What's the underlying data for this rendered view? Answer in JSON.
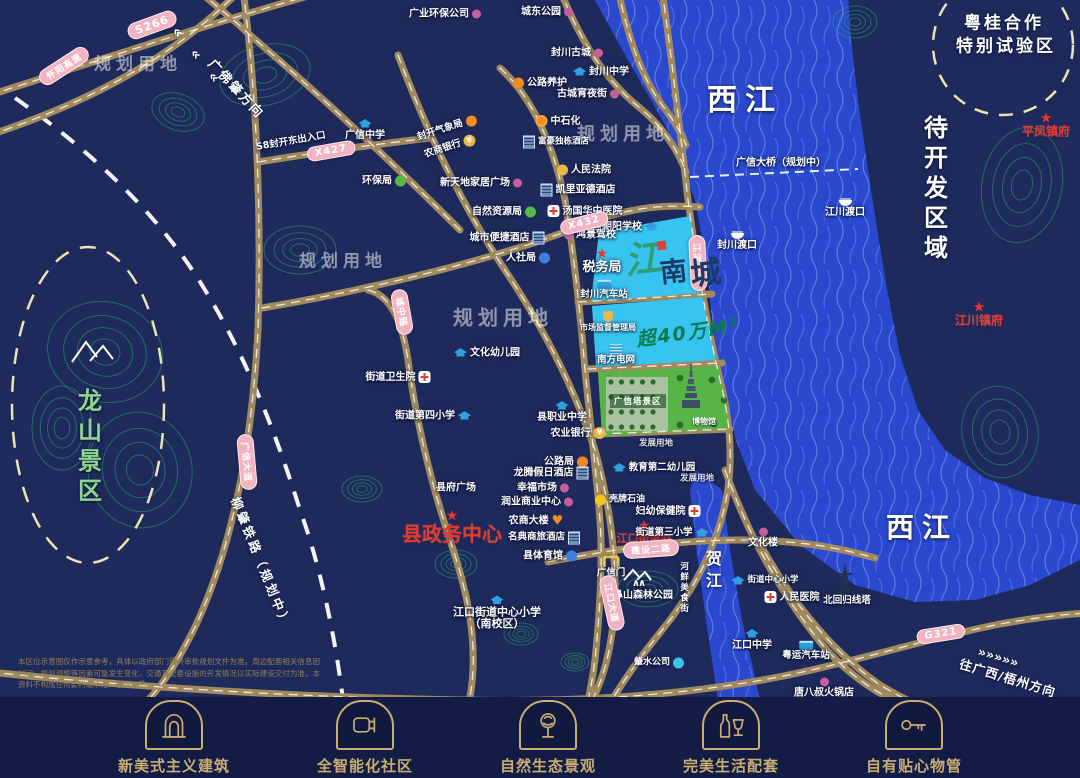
{
  "palette": {
    "bg": "#1f2a5c",
    "bar_bg": "#131c45",
    "water": "#2b49cf",
    "plot_blue": "#38c4f0",
    "park_green": "#57b548",
    "road": "#a18a5e",
    "badge_pink": "#f2b3c3",
    "gold": "#c9ad72",
    "red": "#e8392e"
  },
  "map": {
    "project": {
      "logo": "江南城",
      "area": "超40万M²",
      "park_label": "广信塔景区",
      "museum_label": "博物馆"
    },
    "planning_labels": [
      {
        "t": "规划用地",
        "x": 138,
        "y": 62,
        "s": 17
      },
      {
        "t": "规划用地",
        "x": 343,
        "y": 259,
        "s": 17
      },
      {
        "t": "规划用地",
        "x": 503,
        "y": 316,
        "s": 20
      },
      {
        "t": "规划用地",
        "x": 623,
        "y": 133,
        "s": 18
      }
    ],
    "area_labels": [
      {
        "t": "西江",
        "x": 745,
        "y": 97,
        "s": 30,
        "ls": 8
      },
      {
        "t": "西江",
        "x": 922,
        "y": 526,
        "s": 28,
        "ls": 8
      },
      {
        "t": "贺江",
        "x": 712,
        "y": 572,
        "s": 16,
        "v": true
      },
      {
        "t": "待开发区域",
        "x": 934,
        "y": 190,
        "s": 24,
        "v": true
      },
      {
        "t": "龙山景区",
        "x": 88,
        "y": 448,
        "s": 24,
        "v": true,
        "c": "green"
      },
      {
        "t": "粤桂合作",
        "x": 1004,
        "y": 21,
        "s": 17,
        "ls": 3
      },
      {
        "t": "特别试验区",
        "x": 1006,
        "y": 44,
        "s": 17,
        "ls": 3
      },
      {
        "t": "柳肇铁路（规划中）",
        "x": 262,
        "y": 562,
        "s": 12.5,
        "r": 68,
        "ls": 3
      },
      {
        "t": "广佛肇方向",
        "x": 237,
        "y": 88,
        "s": 13,
        "r": 47,
        "ls": 2
      },
      {
        "t": "«",
        "x": 178,
        "y": 32,
        "s": 15,
        "r": 47
      },
      {
        "t": "«",
        "x": 196,
        "y": 54,
        "s": 15,
        "r": 47
      },
      {
        "t": "«",
        "x": 214,
        "y": 77,
        "s": 15,
        "r": 47
      },
      {
        "t": "»»»»»",
        "x": 998,
        "y": 658,
        "s": 13,
        "r": 17
      },
      {
        "t": "往广西/梧州方向",
        "x": 1008,
        "y": 677,
        "s": 12.5,
        "r": 17,
        "ls": 1
      }
    ],
    "road_badges": [
      {
        "t": "S266",
        "x": 152,
        "y": 25,
        "r": -20,
        "s": 11
      },
      {
        "t": "怀阳高速",
        "x": 64,
        "y": 66,
        "r": -33,
        "s": 9
      },
      {
        "t": "X427",
        "x": 331,
        "y": 151,
        "r": -10,
        "s": 10
      },
      {
        "t": "X432",
        "x": 584,
        "y": 223,
        "r": -14,
        "s": 10
      },
      {
        "t": "G321",
        "x": 941,
        "y": 634,
        "r": -9,
        "s": 10
      },
      {
        "t": "建设二路",
        "x": 651,
        "y": 549,
        "r": -4,
        "s": 9
      },
      {
        "t": "广信大道",
        "x": 247,
        "y": 462,
        "r": 85,
        "s": 9
      },
      {
        "t": "城中路",
        "x": 402,
        "y": 312,
        "r": 80,
        "s": 9
      },
      {
        "t": "江滨大道",
        "x": 698,
        "y": 263,
        "r": 87,
        "s": 9
      },
      {
        "t": "江口大道",
        "x": 612,
        "y": 603,
        "r": 78,
        "s": 9
      }
    ],
    "pois": [
      {
        "t": "广业环保公司",
        "x": 445,
        "y": 14,
        "i": "dot",
        "p": "r"
      },
      {
        "t": "城东公园",
        "x": 547,
        "y": 12,
        "i": "dot",
        "p": "r"
      },
      {
        "t": "封川古城",
        "x": 577,
        "y": 53,
        "i": "dot",
        "p": "r"
      },
      {
        "t": "封川中学",
        "x": 601,
        "y": 72,
        "i": "school",
        "p": "l"
      },
      {
        "t": "公路养护",
        "x": 540,
        "y": 83,
        "i": "orange",
        "p": "l"
      },
      {
        "t": "古城宵夜街",
        "x": 588,
        "y": 94,
        "i": "dot",
        "p": "r"
      },
      {
        "t": "广信中学",
        "x": 365,
        "y": 130,
        "i": "school",
        "p": "a"
      },
      {
        "t": "中石化",
        "x": 558,
        "y": 121,
        "i": "gas",
        "p": "l"
      },
      {
        "t": "封开气象局",
        "x": 447,
        "y": 129,
        "i": "orange",
        "p": "r",
        "r": -18,
        "s": 9.5
      },
      {
        "t": "农商银行",
        "x": 450,
        "y": 147,
        "i": "bank",
        "p": "r",
        "r": -18,
        "s": 9.5
      },
      {
        "t": "富豪独栋酒店",
        "x": 556,
        "y": 142,
        "i": "building",
        "p": "l",
        "s": 8.5
      },
      {
        "t": "环保局",
        "x": 384,
        "y": 181,
        "i": "green",
        "p": "r"
      },
      {
        "t": "新天地家居广场",
        "x": 481,
        "y": 183,
        "i": "dot",
        "p": "r"
      },
      {
        "t": "人民法院",
        "x": 584,
        "y": 170,
        "i": "court",
        "p": "l"
      },
      {
        "t": "凯里亚德酒店",
        "x": 578,
        "y": 190,
        "i": "building",
        "p": "l"
      },
      {
        "t": "汤国华中医院",
        "x": 585,
        "y": 211,
        "i": "cross",
        "p": "l"
      },
      {
        "t": "广信朝阳学校",
        "x": 620,
        "y": 227,
        "i": "school",
        "p": "r"
      },
      {
        "t": "自然资源局",
        "x": 504,
        "y": 212,
        "i": "green",
        "p": "r"
      },
      {
        "t": "城市便捷酒店",
        "x": 507,
        "y": 238,
        "i": "building",
        "p": "r"
      },
      {
        "t": "人社局",
        "x": 528,
        "y": 258,
        "i": "blue",
        "p": "r"
      },
      {
        "t": "鸿景驾校",
        "x": 590,
        "y": 235,
        "i": "dot",
        "p": "l"
      },
      {
        "t": "税务局",
        "x": 602,
        "y": 262,
        "s": 13,
        "star": true
      },
      {
        "t": "封川汽车站",
        "x": 604,
        "y": 290,
        "i": "bus",
        "p": "a",
        "s": 9.5
      },
      {
        "t": "市场监督管理局",
        "x": 608,
        "y": 322,
        "i": "police",
        "p": "a",
        "s": 8
      },
      {
        "t": "南方电网",
        "x": 616,
        "y": 355,
        "i": "power",
        "p": "a",
        "s": 9.5
      },
      {
        "t": "文化幼儿园",
        "x": 487,
        "y": 353,
        "i": "school",
        "p": "l"
      },
      {
        "t": "街道卫生院",
        "x": 398,
        "y": 377,
        "i": "cross",
        "p": "r"
      },
      {
        "t": "街道第四小学",
        "x": 433,
        "y": 416,
        "i": "school",
        "p": "r"
      },
      {
        "t": "县职业中学",
        "x": 562,
        "y": 412,
        "i": "school",
        "p": "a"
      },
      {
        "t": "农业银行",
        "x": 578,
        "y": 433,
        "i": "bank",
        "p": "r"
      },
      {
        "t": "发展用地",
        "x": 656,
        "y": 444,
        "s": 8.5,
        "o": 0.85
      },
      {
        "t": "发展用地",
        "x": 697,
        "y": 479,
        "s": 8.5,
        "o": 0.85
      },
      {
        "t": "公路局",
        "x": 566,
        "y": 462,
        "i": "orange",
        "p": "r"
      },
      {
        "t": "龙腾假日酒店",
        "x": 551,
        "y": 473,
        "i": "building",
        "p": "r"
      },
      {
        "t": "幸福市场",
        "x": 543,
        "y": 488,
        "i": "dot",
        "p": "r"
      },
      {
        "t": "润业商业中心",
        "x": 537,
        "y": 502,
        "i": "dot",
        "p": "r"
      },
      {
        "t": "县府广场",
        "x": 456,
        "y": 488
      },
      {
        "t": "县政务中心",
        "x": 452,
        "y": 528,
        "c": "red",
        "s": 20,
        "star": true
      },
      {
        "t": "农商大楼",
        "x": 536,
        "y": 521,
        "i": "heart",
        "p": "r"
      },
      {
        "t": "名典商旅酒店",
        "x": 544,
        "y": 538,
        "i": "building",
        "p": "r",
        "s": 9.5
      },
      {
        "t": "县体育馆",
        "x": 550,
        "y": 556,
        "i": "blue",
        "p": "r"
      },
      {
        "t": "壳牌石油",
        "x": 620,
        "y": 500,
        "i": "shell",
        "p": "l",
        "s": 9
      },
      {
        "t": "江口街道办",
        "x": 644,
        "y": 533,
        "c": "red",
        "s": 11,
        "star": true
      },
      {
        "t": "教育第二幼儿园",
        "x": 654,
        "y": 468,
        "i": "school",
        "p": "l",
        "s": 9.5
      },
      {
        "t": "妇幼保健院",
        "x": 668,
        "y": 511,
        "i": "cross",
        "p": "r"
      },
      {
        "t": "街道第三小学",
        "x": 672,
        "y": 533,
        "i": "school",
        "p": "r",
        "s": 9.5
      },
      {
        "t": "广信门",
        "x": 611,
        "y": 567,
        "i": "gate",
        "p": "a",
        "s": 9.5
      },
      {
        "t": "虎鼻山森林公园",
        "x": 638,
        "y": 590,
        "i": "mountain",
        "p": "a"
      },
      {
        "t": "河鲜美食街",
        "x": 683,
        "y": 588,
        "v": true,
        "s": 8.5
      },
      {
        "t": "江口街道中心小学",
        "x": 497,
        "y": 607,
        "i": "school",
        "p": "a",
        "s": 11
      },
      {
        "t": "（南校区）",
        "x": 497,
        "y": 624,
        "s": 11
      },
      {
        "t": "文化楼",
        "x": 763,
        "y": 538,
        "i": "dot",
        "p": "a"
      },
      {
        "t": "街道中心小学",
        "x": 765,
        "y": 581,
        "i": "school",
        "p": "l",
        "s": 8.5
      },
      {
        "t": "人民医院",
        "x": 792,
        "y": 597,
        "i": "cross",
        "p": "l"
      },
      {
        "t": "北回归线塔",
        "x": 847,
        "y": 601,
        "s": 9.5
      },
      {
        "t": "江口中学",
        "x": 752,
        "y": 640,
        "i": "school",
        "p": "a"
      },
      {
        "t": "粤运汽车站",
        "x": 806,
        "y": 651,
        "i": "bus",
        "p": "a",
        "s": 9.5
      },
      {
        "t": "唐八叔火锅店",
        "x": 824,
        "y": 688,
        "i": "dot",
        "p": "a"
      },
      {
        "t": "肇水公司",
        "x": 659,
        "y": 663,
        "i": "water",
        "p": "r",
        "s": 9
      },
      {
        "t": "平凤镇府",
        "x": 1046,
        "y": 126,
        "c": "red",
        "s": 12,
        "star": true
      },
      {
        "t": "江川镇府",
        "x": 979,
        "y": 315,
        "c": "red",
        "s": 12,
        "star": true
      },
      {
        "t": "江川渡口",
        "x": 845,
        "y": 209,
        "i": "boat",
        "p": "a"
      },
      {
        "t": "封川渡口",
        "x": 737,
        "y": 242,
        "i": "boat",
        "p": "a"
      },
      {
        "t": "广信大桥（规划中）",
        "x": 781,
        "y": 163,
        "s": 10
      },
      {
        "t": "S8封开东出入口",
        "x": 291,
        "y": 142,
        "s": 9.5,
        "r": -10
      }
    ]
  },
  "features": [
    {
      "label": "新美式主义建筑",
      "icon": "arch-door"
    },
    {
      "label": "全智能化社区",
      "icon": "smart-plug"
    },
    {
      "label": "自然生态景观",
      "icon": "tree"
    },
    {
      "label": "完美生活配套",
      "icon": "wine"
    },
    {
      "label": "自有贴心物管",
      "icon": "key"
    }
  ],
  "disclaimer": "本区位示意图仅作示意参考，具体以政府部门最终审批规划文件为准。周边配套相关信息因时间、规划调整等因素可能发生变化，交通及配套设施的开发情况以实际建设交付为准，本资料不构成任何要约或承诺，敬请知悉。"
}
